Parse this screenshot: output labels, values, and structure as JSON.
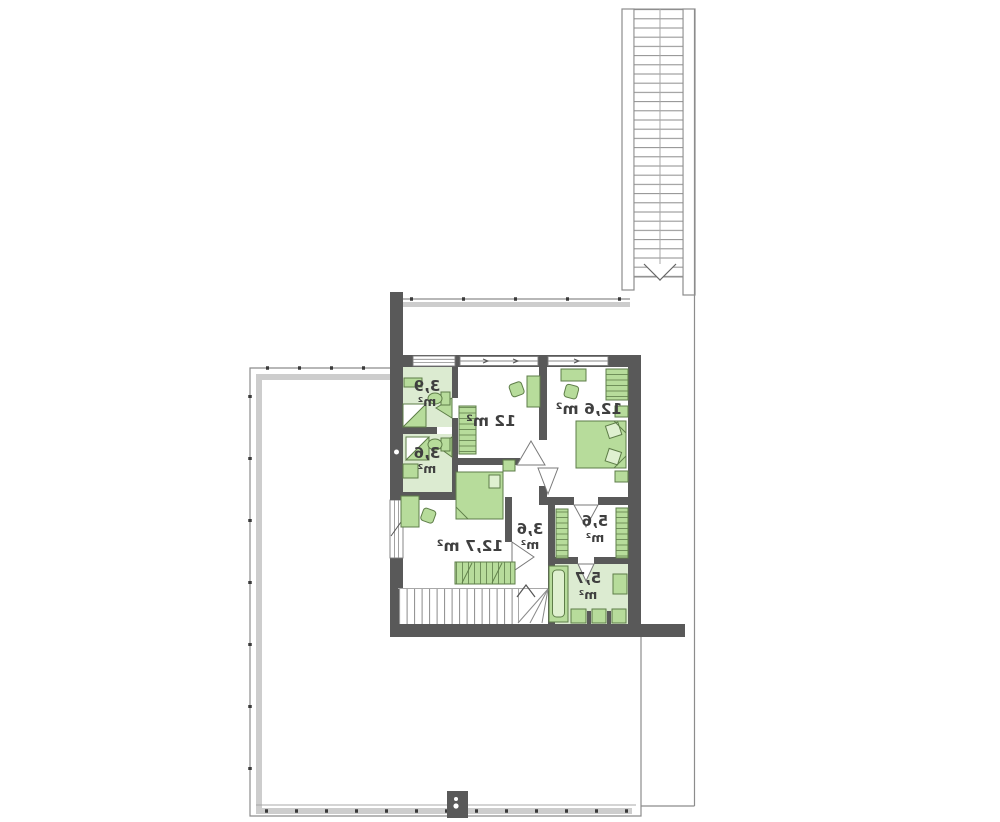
{
  "floor_plan": {
    "orientation": "mirrored",
    "rooms": {
      "bath_top": {
        "name": "bathroom-top",
        "area": "3,9",
        "unit": "m²"
      },
      "bath_mid": {
        "name": "bathroom-middle",
        "area": "3,6",
        "unit": "m²"
      },
      "bedroom_top": {
        "name": "bedroom-top",
        "label": "12 m²"
      },
      "bedroom_right": {
        "name": "bedroom-right",
        "label": "12,6 m²"
      },
      "hall": {
        "name": "hall",
        "area": "3,6",
        "unit": "m²"
      },
      "bedroom_left": {
        "name": "bedroom-left",
        "label": "12,7 m²"
      },
      "wardrobe": {
        "name": "walk-in-wardrobe",
        "area": "5,6",
        "unit": "m²"
      },
      "bath_bottom": {
        "name": "bathroom-bottom",
        "area": "5,7",
        "unit": "m²"
      }
    },
    "colors": {
      "wall": "#595959",
      "bathroom_floor": "#dcebd1",
      "furniture_fill": "#b7dc9b",
      "furniture_stroke": "#5e7d48",
      "railing_band": "#cdcdcd",
      "outline": "#8c8c8c",
      "label_text": "#3f3f3f"
    }
  }
}
